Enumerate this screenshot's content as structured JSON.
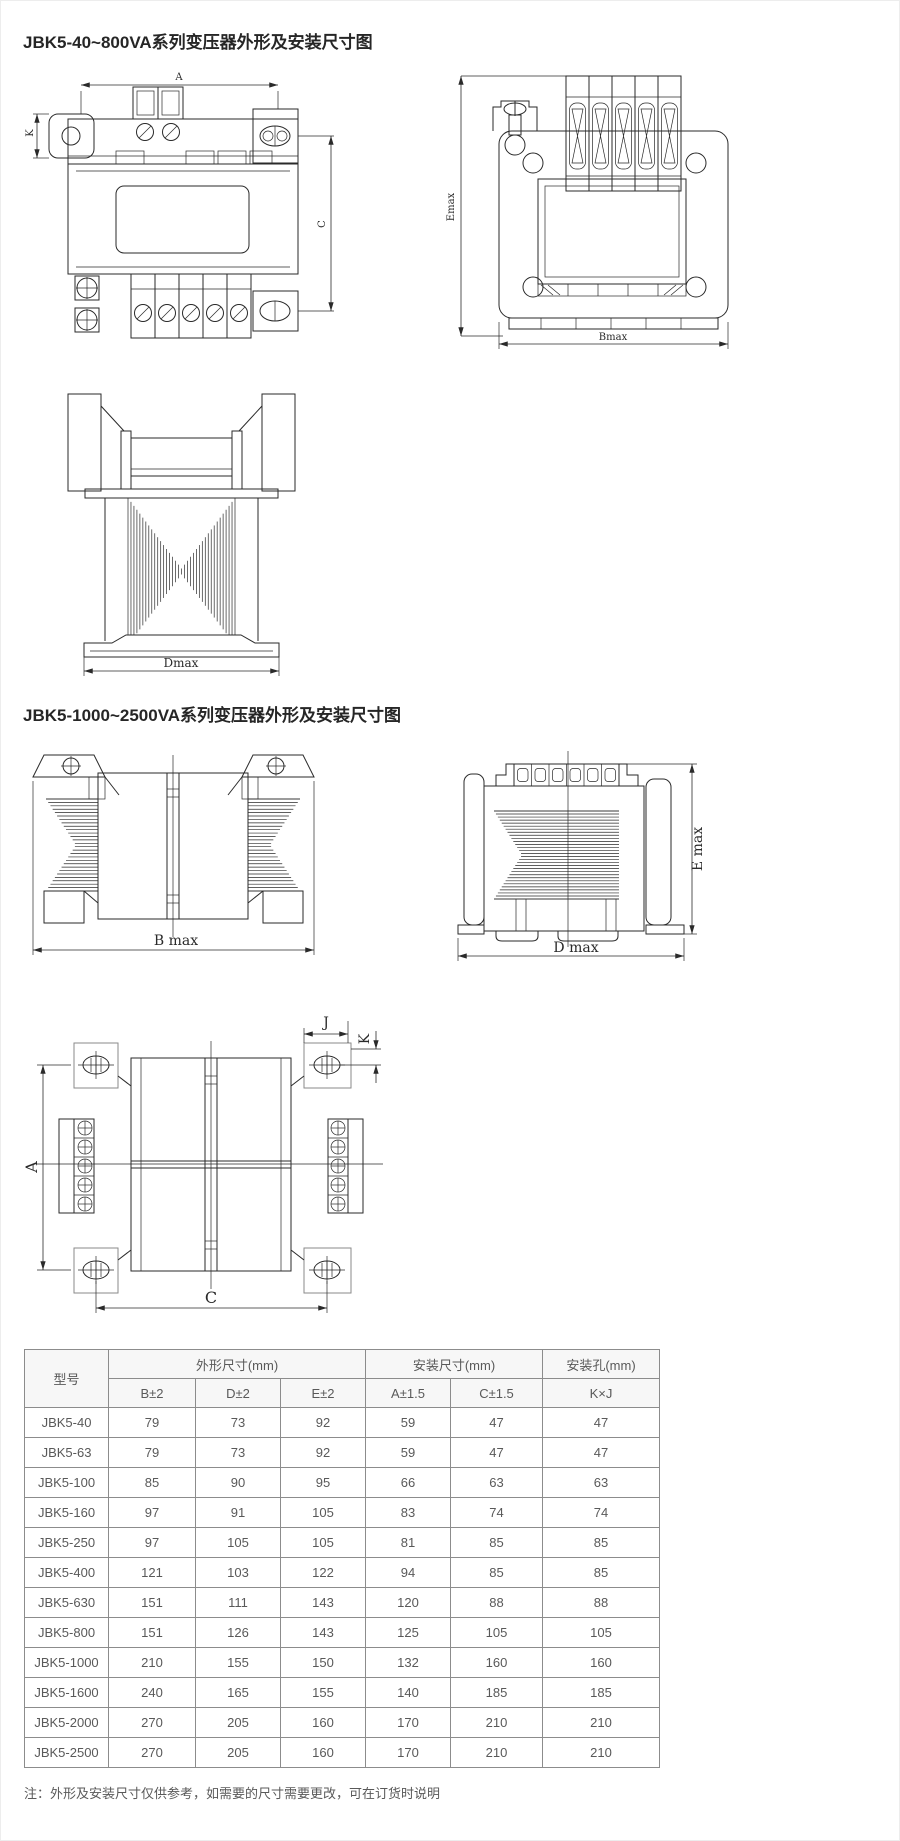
{
  "colors": {
    "line": "#2a2a2a",
    "table_border": "#8c8c8c",
    "text": "#595959",
    "header_bg": "#f7f7f7",
    "title": "#262626"
  },
  "sections": [
    {
      "title": "JBK5-40~800VA系列变压器外形及安装尺寸图"
    },
    {
      "title": "JBK5-1000~2500VA系列变压器外形及安装尺寸图"
    }
  ],
  "drawings": {
    "small_front": {
      "dim_a": "A",
      "dim_k": "K",
      "dim_c": "C"
    },
    "small_side": {
      "dim_emax": "Emax",
      "dim_bmax": "Bmax"
    },
    "small_bottom": {
      "dim_dmax": "Dmax"
    },
    "large_front": {
      "dim_bmax": "B max"
    },
    "large_side": {
      "dim_emax": "E max",
      "dim_dmax": "D max"
    },
    "large_top": {
      "dim_a": "A",
      "dim_c": "C",
      "dim_j": "J",
      "dim_k": "K"
    }
  },
  "table": {
    "header": {
      "model": "型号",
      "groups": [
        {
          "label": "外形尺寸(mm)",
          "cols": [
            "B±2",
            "D±2",
            "E±2"
          ]
        },
        {
          "label": "安装尺寸(mm)",
          "cols": [
            "A±1.5",
            "C±1.5"
          ]
        },
        {
          "label": "安装孔(mm)",
          "cols": [
            "K×J"
          ]
        }
      ]
    },
    "rows": [
      {
        "model": "JBK5-40",
        "b": "79",
        "d": "73",
        "e": "92",
        "a": "59",
        "c": "47",
        "kj": "47"
      },
      {
        "model": "JBK5-63",
        "b": "79",
        "d": "73",
        "e": "92",
        "a": "59",
        "c": "47",
        "kj": "47"
      },
      {
        "model": "JBK5-100",
        "b": "85",
        "d": "90",
        "e": "95",
        "a": "66",
        "c": "63",
        "kj": "63"
      },
      {
        "model": "JBK5-160",
        "b": "97",
        "d": "91",
        "e": "105",
        "a": "83",
        "c": "74",
        "kj": "74"
      },
      {
        "model": "JBK5-250",
        "b": "97",
        "d": "105",
        "e": "105",
        "a": "81",
        "c": "85",
        "kj": "85"
      },
      {
        "model": "JBK5-400",
        "b": "121",
        "d": "103",
        "e": "122",
        "a": "94",
        "c": "85",
        "kj": "85"
      },
      {
        "model": "JBK5-630",
        "b": "151",
        "d": "111",
        "e": "143",
        "a": "120",
        "c": "88",
        "kj": "88"
      },
      {
        "model": "JBK5-800",
        "b": "151",
        "d": "126",
        "e": "143",
        "a": "125",
        "c": "105",
        "kj": "105"
      },
      {
        "model": "JBK5-1000",
        "b": "210",
        "d": "155",
        "e": "150",
        "a": "132",
        "c": "160",
        "kj": "160"
      },
      {
        "model": "JBK5-1600",
        "b": "240",
        "d": "165",
        "e": "155",
        "a": "140",
        "c": "185",
        "kj": "185"
      },
      {
        "model": "JBK5-2000",
        "b": "270",
        "d": "205",
        "e": "160",
        "a": "170",
        "c": "210",
        "kj": "210"
      },
      {
        "model": "JBK5-2500",
        "b": "270",
        "d": "205",
        "e": "160",
        "a": "170",
        "c": "210",
        "kj": "210"
      }
    ]
  },
  "note": "注：外形及安装尺寸仅供参考，如需要的尺寸需要更改，可在订货时说明"
}
